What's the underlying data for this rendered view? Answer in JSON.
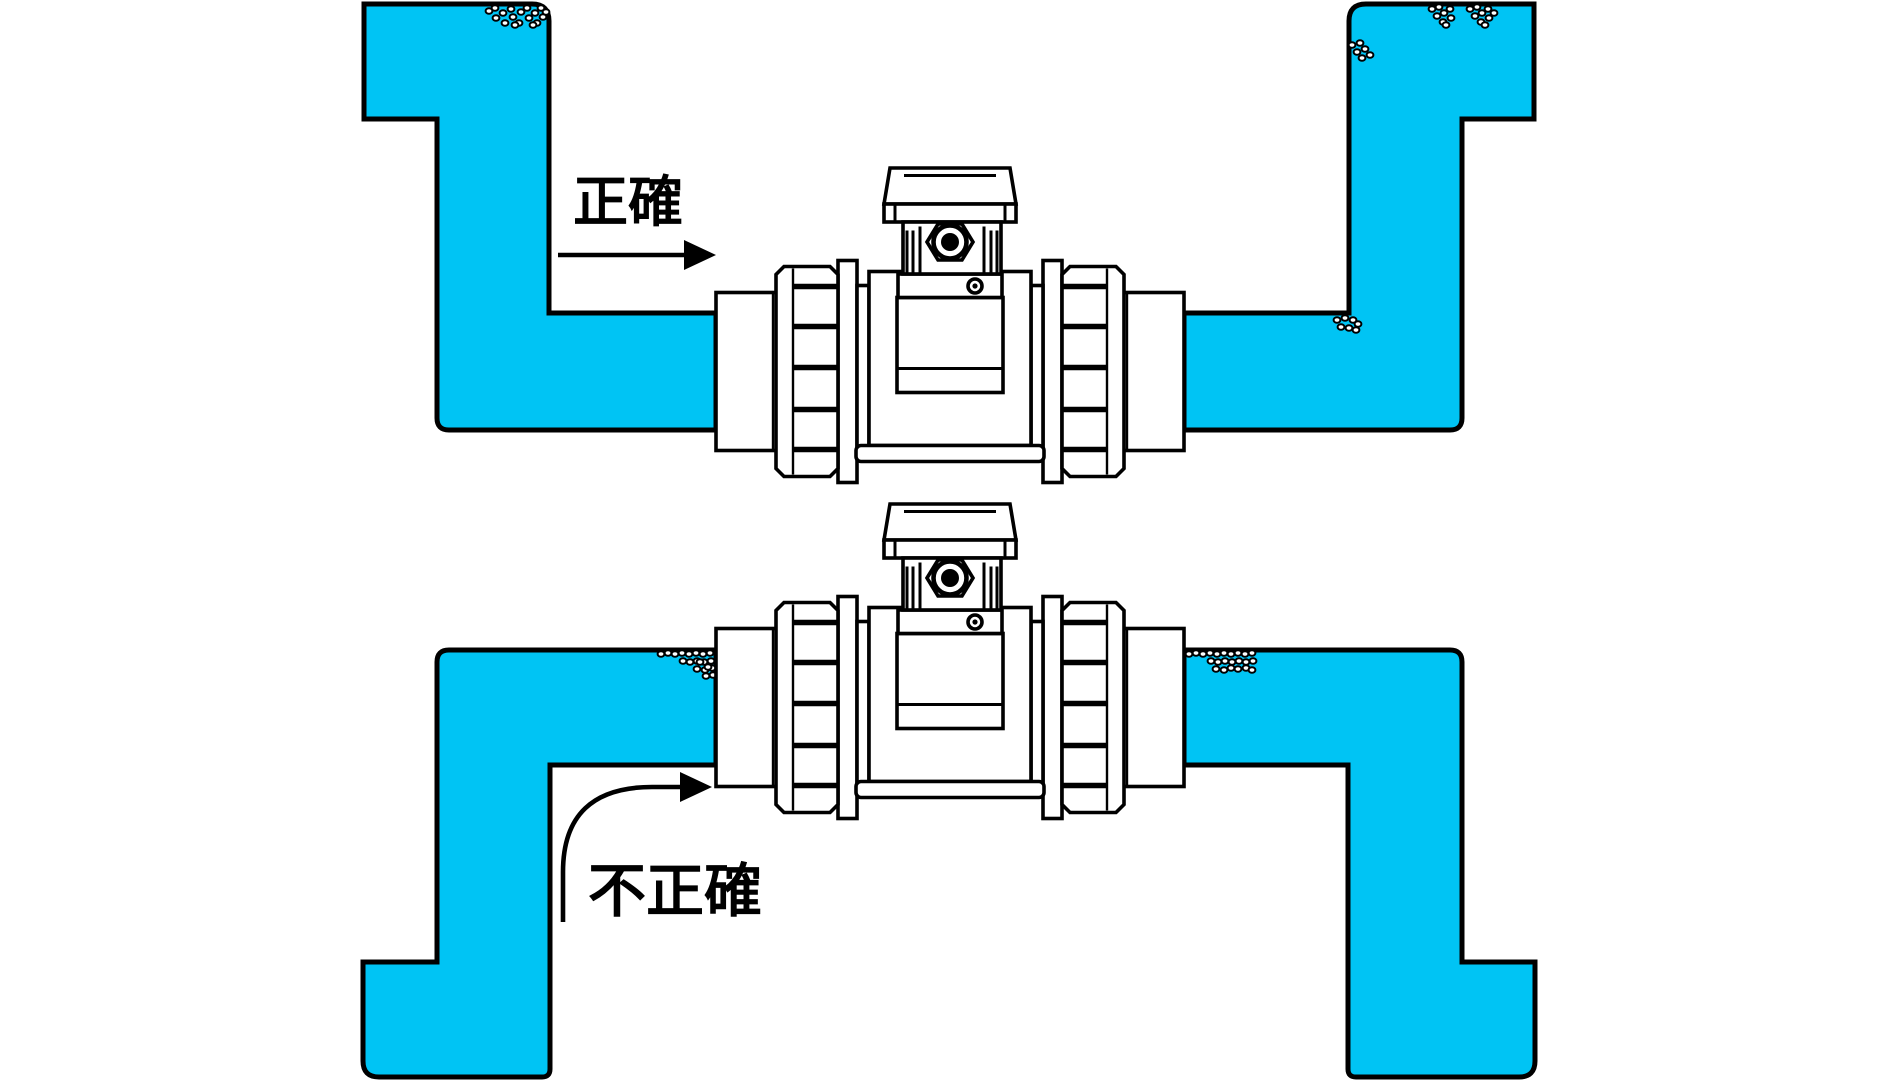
{
  "figure": {
    "type": "piping-installation-diagram",
    "background": "#FFFFFF"
  },
  "colors": {
    "water": "#00C4F4",
    "line": "#000000",
    "fixture": "#FFFFFF",
    "background": "#FFFFFF"
  },
  "diagrams": [
    {
      "id": "correct",
      "label": "正確",
      "arrow": "straight-right-into-meter"
    },
    {
      "id": "incorrect",
      "label": "不正確",
      "arrow": "curved-up-right-into-meter"
    }
  ]
}
